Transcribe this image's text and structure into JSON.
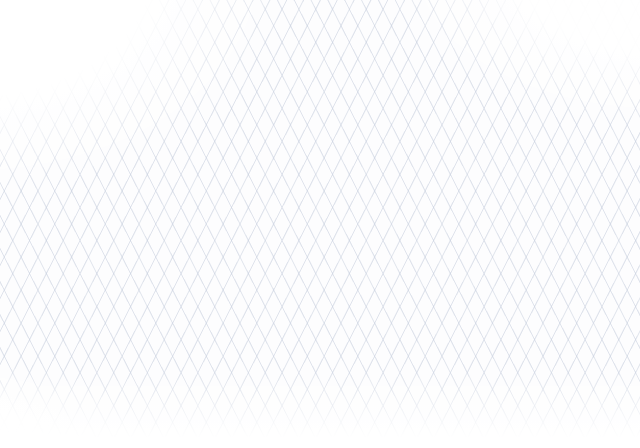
{
  "scene": {
    "width": 640,
    "height": 448,
    "kind": "isometric-copper-piping-illustration"
  },
  "colors": {
    "grid_line": "#c6cedd",
    "ink": "#3b414d",
    "sketch": "#99a2b0",
    "copper_outline": "#53290f",
    "copper_base": "#b96a38",
    "copper_mid": "#d88f58",
    "copper_highlight": "#f6bd8f",
    "copper_glint": "#ffe9d2",
    "brass_base": "#c8a23d",
    "brass_highlight": "#ecd17e",
    "brass_outline": "#5d4a12",
    "bronze_base": "#b08136",
    "bronze_highlight": "#dcb46a",
    "silver_base": "#c4cad2",
    "silver_highlight": "#eef1f5",
    "handle_blue": "#3f7bd9",
    "handle_blue_dark": "#1e3c77",
    "handle_blue_light": "#8ab4ef",
    "pump_top": "#d8dce2",
    "pump_front": "#b4bac4",
    "pump_side": "#8f96a2",
    "pump_outline": "#5c6370"
  },
  "labels": [
    {
      "t": "BALL VALVE",
      "x": 531,
      "y": 178,
      "r": -4,
      "s": 9
    },
    {
      "t": "GATE VALVE",
      "x": 377,
      "y": 250,
      "r": -6,
      "s": 8.5
    },
    {
      "t": "REDUCER",
      "x": 341,
      "y": 194,
      "r": -25,
      "s": 7
    },
    {
      "t": "CORQ",
      "x": 419,
      "y": 61,
      "r": -5,
      "s": 6.5
    },
    {
      "t": "PRESSON",
      "x": 421,
      "y": 70,
      "r": -5,
      "s": 6.5
    },
    {
      "t": "MODRIA",
      "x": 444,
      "y": 147,
      "r": -3,
      "s": 6
    },
    {
      "t": "DRANOFF",
      "x": 458,
      "y": 300,
      "r": -12,
      "s": 7
    },
    {
      "t": "LOLOU DIM",
      "x": 532,
      "y": 203,
      "r": -8,
      "s": 5.5
    },
    {
      "t": "DEVLOR",
      "x": 538,
      "y": 212,
      "r": -8,
      "s": 5.5
    },
    {
      "t": "PIPE",
      "x": 563,
      "y": 226,
      "r": -10,
      "s": 6
    },
    {
      "t": "DOPE",
      "x": 571,
      "y": 240,
      "r": -6,
      "s": 6
    },
    {
      "t": "I2DA",
      "x": 606,
      "y": 228,
      "r": 0,
      "s": 5.5
    },
    {
      "t": "RAMP",
      "x": 607,
      "y": 235,
      "r": 0,
      "s": 5.5
    },
    {
      "t": "1/2 CU",
      "x": 124,
      "y": 108,
      "r": -10,
      "s": 6
    },
    {
      "t": "7/8",
      "x": 147,
      "y": 167,
      "r": -15,
      "s": 6
    },
    {
      "t": "1/2",
      "x": 159,
      "y": 181,
      "r": -15,
      "s": 6
    },
    {
      "t": "NIPPLE",
      "x": 236,
      "y": 128,
      "r": -25,
      "s": 5.5
    },
    {
      "t": "UNION",
      "x": 461,
      "y": 177,
      "r": -25,
      "s": 6
    },
    {
      "t": "TYP",
      "x": 527,
      "y": 120,
      "r": 0,
      "s": 5.5
    },
    {
      "t": "NOM",
      "x": 553,
      "y": 128,
      "r": 0,
      "s": 5.5
    },
    {
      "t": "SOLDER",
      "x": 251,
      "y": 287,
      "r": -10,
      "s": 5.5
    },
    {
      "t": "JOINT",
      "x": 264,
      "y": 296,
      "r": -10,
      "s": 5.5
    },
    {
      "t": "90 ELL",
      "x": 236,
      "y": 279,
      "r": -10,
      "s": 5.5
    },
    {
      "t": "BRACE",
      "x": 344,
      "y": 287,
      "r": -8,
      "s": 5.5
    },
    {
      "t": "RISER",
      "x": 351,
      "y": 295,
      "r": -8,
      "s": 5.5
    },
    {
      "t": "SLEEVE",
      "x": 311,
      "y": 337,
      "r": -8,
      "s": 5.5
    },
    {
      "t": "W/ FLG",
      "x": 326,
      "y": 345,
      "r": -8,
      "s": 5.5
    },
    {
      "t": "PIPE NL.TN",
      "x": 388,
      "y": 268,
      "r": -8,
      "s": 6
    },
    {
      "t": "DROP",
      "x": 419,
      "y": 346,
      "r": -8,
      "s": 6
    },
    {
      "t": "3/4 CU",
      "x": 314,
      "y": 404,
      "r": -8,
      "s": 6
    },
    {
      "t": "STRAP",
      "x": 92,
      "y": 238,
      "r": -10,
      "s": 5.5
    },
    {
      "t": "2-6",
      "x": 468,
      "y": 85,
      "r": 0,
      "s": 6
    },
    {
      "t": "3/4",
      "x": 55,
      "y": 144,
      "r": -12,
      "s": 6
    }
  ],
  "pipes": [
    {
      "name": "top-right-stub",
      "w": 10,
      "pts": [
        [
          553,
          8
        ],
        [
          640,
          48
        ]
      ]
    },
    {
      "name": "supply-top-run",
      "w": 10,
      "pts": [
        [
          272,
          26
        ],
        [
          512,
          138
        ]
      ]
    },
    {
      "name": "riser-main",
      "w": 10,
      "pts": [
        [
          350,
          62
        ],
        [
          350,
          134
        ]
      ]
    },
    {
      "name": "valve1-branch",
      "w": 9,
      "pts": [
        [
          106,
          133
        ],
        [
          205,
          86
        ],
        [
          240,
          78
        ]
      ]
    },
    {
      "name": "valve1-link",
      "w": 9,
      "pts": [
        [
          240,
          78
        ],
        [
          350,
          132
        ]
      ]
    },
    {
      "name": "stop-valve-run",
      "w": 9,
      "pts": [
        [
          46,
          190
        ],
        [
          60,
          173
        ],
        [
          85,
          151
        ],
        [
          348,
          62
        ]
      ]
    },
    {
      "name": "union-link",
      "w": 10,
      "pts": [
        [
          512,
          138
        ],
        [
          436,
          173
        ]
      ]
    },
    {
      "name": "upper-left-main",
      "w": 10,
      "pts": [
        [
          23,
          283
        ],
        [
          350,
          133
        ]
      ]
    },
    {
      "name": "flange-riser",
      "w": 8,
      "pts": [
        [
          253,
          178
        ],
        [
          253,
          153
        ]
      ]
    },
    {
      "name": "wheel-riser",
      "w": 7,
      "pts": [
        [
          296,
          158
        ],
        [
          296,
          134
        ]
      ]
    },
    {
      "name": "loop-north-east",
      "w": 10,
      "pts": [
        [
          350,
          133
        ],
        [
          520,
          212
        ]
      ]
    },
    {
      "name": "center-branch",
      "w": 9,
      "pts": [
        [
          115,
          122
        ],
        [
          430,
          272
        ],
        [
          474,
          294
        ]
      ]
    },
    {
      "name": "gate-valve-run",
      "w": 9,
      "pts": [
        [
          320,
          278
        ],
        [
          555,
          169
        ],
        [
          608,
          196
        ]
      ]
    },
    {
      "name": "right-outlet-run",
      "w": 10,
      "pts": [
        [
          520,
          212
        ],
        [
          640,
          272
        ]
      ]
    },
    {
      "name": "left-double-run",
      "w": 9,
      "pts": [
        [
          10,
          268
        ],
        [
          196,
          358
        ]
      ]
    },
    {
      "name": "loop-west-south",
      "w": 10,
      "pts": [
        [
          23,
          283
        ],
        [
          208,
          372
        ]
      ]
    },
    {
      "name": "loop-south-east",
      "w": 10,
      "pts": [
        [
          208,
          372
        ],
        [
          520,
          212
        ]
      ]
    },
    {
      "name": "lower-double-run",
      "w": 9,
      "pts": [
        [
          222,
          386
        ],
        [
          534,
          233
        ]
      ]
    },
    {
      "name": "drain-run",
      "w": 9,
      "pts": [
        [
          352,
          402
        ],
        [
          352,
          373
        ],
        [
          620,
          249
        ]
      ]
    },
    {
      "name": "small-branch",
      "w": 8,
      "pts": [
        [
          132,
          263
        ],
        [
          232,
          313
        ]
      ]
    },
    {
      "name": "drop-stub",
      "w": 7,
      "pts": [
        [
          388,
          383
        ],
        [
          442,
          358
        ]
      ]
    }
  ],
  "rings": [
    {
      "x": 282,
      "y": 31,
      "dir": "v",
      "style": "c",
      "big": true
    },
    {
      "x": 553,
      "y": 8,
      "dir": "v",
      "style": "c"
    },
    {
      "x": 598,
      "y": 28,
      "dir": "v",
      "style": "c",
      "big": true
    },
    {
      "x": 420,
      "y": 92,
      "dir": "v",
      "style": "b",
      "big": true
    },
    {
      "x": 448,
      "y": 108,
      "dir": "v",
      "style": "s"
    },
    {
      "x": 478,
      "y": 156,
      "dir": "u",
      "style": "z",
      "big": true
    },
    {
      "x": 350,
      "y": 62,
      "dir": "v",
      "style": "c"
    },
    {
      "x": 350,
      "y": 96,
      "dir": "vert",
      "style": "c"
    },
    {
      "x": 350,
      "y": 110,
      "dir": "vert",
      "style": "c"
    },
    {
      "x": 350,
      "y": 133,
      "dir": "v",
      "style": "c"
    },
    {
      "x": 240,
      "y": 78,
      "dir": "u",
      "style": "c"
    },
    {
      "x": 106,
      "y": 133,
      "dir": "u",
      "style": "s"
    },
    {
      "x": 436,
      "y": 173,
      "dir": "u",
      "style": "c"
    },
    {
      "x": 512,
      "y": 138,
      "dir": "v",
      "style": "c"
    },
    {
      "x": 520,
      "y": 212,
      "dir": "v",
      "style": "c"
    },
    {
      "x": 430,
      "y": 272,
      "dir": "v",
      "style": "c"
    },
    {
      "x": 208,
      "y": 372,
      "dir": "v",
      "style": "c"
    },
    {
      "x": 23,
      "y": 283,
      "dir": "v",
      "style": "c"
    },
    {
      "x": 352,
      "y": 373,
      "dir": "vert",
      "style": "c"
    },
    {
      "x": 352,
      "y": 399,
      "dir": "vert",
      "style": "s"
    },
    {
      "x": 637,
      "y": 270,
      "dir": "v",
      "style": "s"
    },
    {
      "x": 155,
      "y": 127,
      "dir": "u",
      "style": "s"
    },
    {
      "x": 253,
      "y": 166,
      "dir": "vert",
      "style": "c"
    },
    {
      "x": 296,
      "y": 146,
      "dir": "vert",
      "style": "c"
    },
    {
      "x": 132,
      "y": 263,
      "dir": "v",
      "style": "c"
    },
    {
      "x": 232,
      "y": 313,
      "dir": "v",
      "style": "c"
    },
    {
      "x": 388,
      "y": 383,
      "dir": "u",
      "style": "c"
    },
    {
      "x": 442,
      "y": 358,
      "dir": "u",
      "style": "s"
    },
    {
      "x": 620,
      "y": 249,
      "dir": "u",
      "style": "s"
    },
    {
      "x": 474,
      "y": 294,
      "dir": "v",
      "style": "s"
    }
  ],
  "valves": [
    {
      "name": "ball-valve-tee-handle-upper",
      "type": "tee-ball",
      "x": 205,
      "y": 88,
      "dir": "u"
    },
    {
      "name": "stop-valve-round-knob",
      "type": "knob-stop",
      "x": 85,
      "y": 150,
      "dir": "u"
    },
    {
      "name": "ball-valve-tee-handle-mid",
      "type": "tee-ball",
      "x": 201,
      "y": 163,
      "dir": "v"
    },
    {
      "name": "globe-valve-center",
      "type": "wheel-globe",
      "x": 345,
      "y": 231,
      "dir": "v"
    },
    {
      "name": "gate-valve-flanged",
      "type": "gate-flanged",
      "x": 437,
      "y": 224,
      "dir": "u"
    },
    {
      "name": "drain-ball-valve",
      "type": "lever-ball",
      "x": 455,
      "y": 325,
      "dir": "u"
    },
    {
      "name": "right-outlet-ball-valve",
      "type": "lever-ball",
      "x": 600,
      "y": 252,
      "dir": "v"
    },
    {
      "name": "small-ball-valve",
      "type": "lever-ball",
      "x": 578,
      "y": 181,
      "dir": "v"
    },
    {
      "name": "branch-ball-valve",
      "type": "lever-ball",
      "x": 182,
      "y": 288,
      "dir": "v"
    },
    {
      "name": "drop-ball-valve",
      "type": "lever-ball",
      "x": 415,
      "y": 369,
      "dir": "u"
    }
  ],
  "flanges": [
    {
      "name": "flange-disc",
      "x": 253,
      "y": 150,
      "rx": 10,
      "ry": 4
    },
    {
      "name": "floor-flange",
      "x": 46,
      "y": 191,
      "type": "floor"
    }
  ],
  "wheel_fitting": {
    "x": 296,
    "y": 130,
    "r": 8
  },
  "pump": {
    "x": 358,
    "y": 62,
    "cylinder": {
      "x": 366,
      "y": 130
    }
  },
  "sketches": [
    {
      "name": "flow-direction-circle",
      "cx": 117,
      "cy": 371,
      "rx": 37,
      "ry": 22
    },
    {
      "name": "spigot-outline",
      "x": 6,
      "y": 228
    },
    {
      "name": "bracket-outline",
      "x": 445,
      "y": 80
    },
    {
      "name": "pump-outline",
      "x": 525,
      "y": 272
    },
    {
      "name": "box-blue-wedge",
      "x": 272,
      "y": 362
    },
    {
      "name": "pipe-outline-vertical",
      "x": 334,
      "y": 342
    },
    {
      "name": "thin-pipe-sketch",
      "pts": [
        [
          543,
          214
        ],
        [
          640,
          168
        ]
      ]
    }
  ],
  "leaders": [
    {
      "pts": [
        [
          540,
          184
        ],
        [
          567,
          193
        ]
      ],
      "arrow": true
    },
    {
      "pts": [
        [
          399,
          246
        ],
        [
          430,
          233
        ]
      ],
      "arrow": true
    },
    {
      "pts": [
        [
          354,
          197
        ],
        [
          338,
          204
        ]
      ],
      "arrow": false
    },
    {
      "pts": [
        [
          425,
          73
        ],
        [
          421,
          86
        ]
      ],
      "arrow": true
    },
    {
      "pts": [
        [
          441,
          147
        ],
        [
          431,
          150
        ]
      ],
      "arrow": true
    },
    {
      "pts": [
        [
          470,
          297
        ],
        [
          456,
          315
        ]
      ],
      "arrow": false
    },
    {
      "pts": [
        [
          448,
          80
        ],
        [
          496,
          102
        ]
      ],
      "arrow": false
    },
    {
      "pts": [
        [
          446,
          76
        ],
        [
          450,
          84
        ]
      ],
      "arrow": false
    },
    {
      "pts": [
        [
          494,
          98
        ],
        [
          498,
          106
        ]
      ],
      "arrow": false
    },
    {
      "pts": [
        [
          316,
          401
        ],
        [
          333,
          395
        ]
      ],
      "arrow": false
    },
    {
      "pts": [
        [
          596,
          14
        ],
        [
          604,
          18
        ]
      ],
      "arrow": false
    },
    {
      "pts": [
        [
          98,
          234
        ],
        [
          82,
          240
        ]
      ],
      "arrow": false
    }
  ]
}
